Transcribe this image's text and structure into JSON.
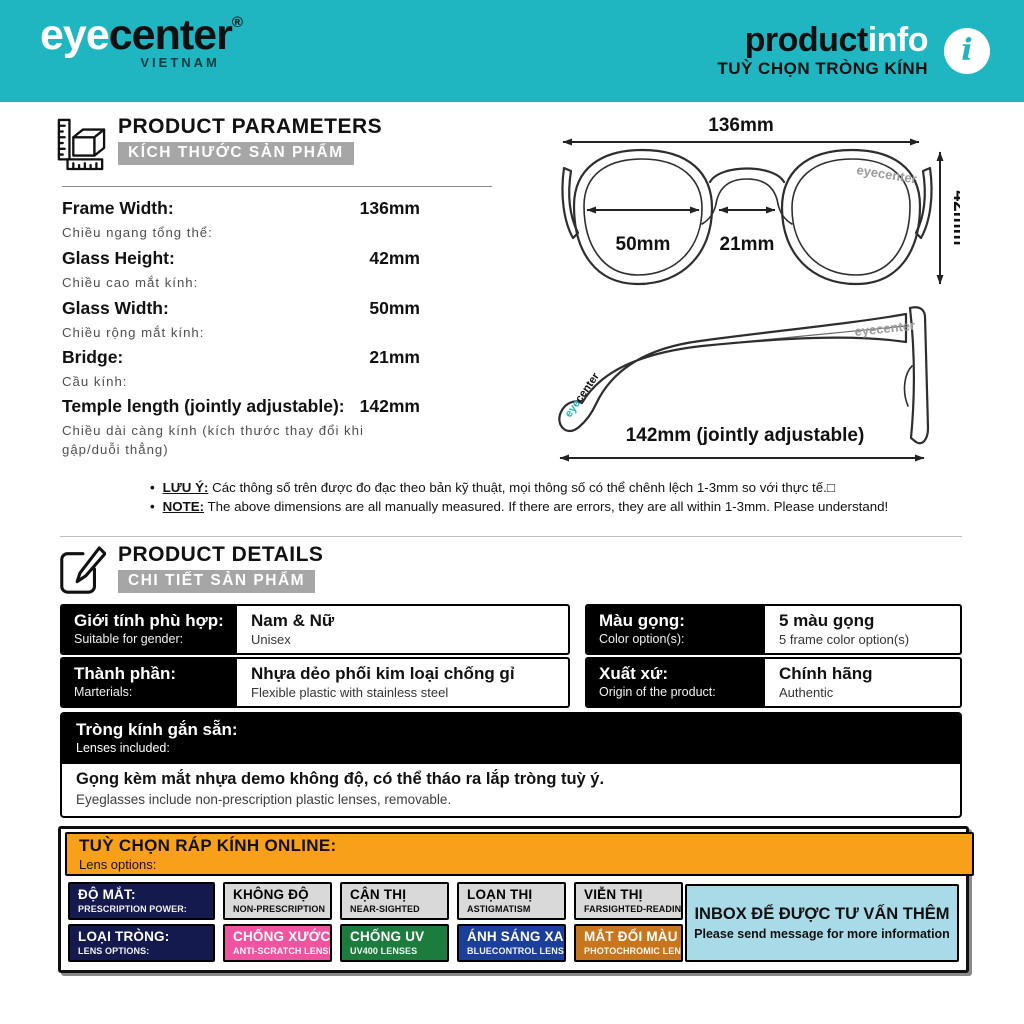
{
  "colors": {
    "teal": "#1FB6C1",
    "gray_badge_bg": "#A6A6A6",
    "orange": "#F9A01B",
    "navy": "#14194E",
    "pink": "#F0539F",
    "green": "#1B7C3D",
    "blue": "#1C3F9C",
    "amber": "#C8761D",
    "light_gray": "#D9D9D9",
    "light_blue": "#A9DAE8"
  },
  "header": {
    "brand_eye": "eye",
    "brand_center": "center",
    "brand_reg": "®",
    "brand_country": "VIETNAM",
    "title_product": "product",
    "title_info": "info",
    "subtitle": "TUỲ CHỌN TRÒNG KÍNH",
    "info_glyph": "i"
  },
  "parameters": {
    "title": "PRODUCT PARAMETERS",
    "subtitle": "KÍCH THƯỚC SẢN PHẨM",
    "rows": [
      {
        "label": "Frame Width:",
        "sub": "Chiều ngang tổng thể:",
        "value": "136mm"
      },
      {
        "label": "Glass Height:",
        "sub": "Chiều cao mắt kính:",
        "value": "42mm"
      },
      {
        "label": "Glass Width:",
        "sub": "Chiều rộng mắt kính:",
        "value": "50mm"
      },
      {
        "label": "Bridge:",
        "sub": "Cầu kính:",
        "value": "21mm"
      },
      {
        "label": "Temple length (jointly adjustable):",
        "sub": "Chiều dài càng kính (kích thước thay đổi khi gập/duỗi thẳng)",
        "value": "142mm"
      }
    ]
  },
  "diagram_front": {
    "width_label": "136mm",
    "height_label": "42mm",
    "lens_label": "50mm",
    "bridge_label": "21mm",
    "watermark": "eyecenter"
  },
  "diagram_side": {
    "length_label": "142mm (jointly adjustable)",
    "watermark": "eyecenter",
    "tip_logo_eye": "eye",
    "tip_logo_center": "center"
  },
  "notes": [
    {
      "bullet": "•",
      "prefix": "LƯU Ý:",
      "text": "Các thông số trên được đo đạc theo bản kỹ thuật, mọi thông số có thể chênh lệch 1-3mm so với thực tế.□"
    },
    {
      "bullet": "•",
      "prefix": "NOTE:",
      "text": "The above dimensions are all manually measured. If there are errors, they are all within 1-3mm. Please understand!"
    }
  ],
  "details": {
    "title": "PRODUCT DETAILS",
    "subtitle": "CHI TIẾT SẢN PHẨM",
    "cells": [
      {
        "label": "Giới tính phù hợp:",
        "label_sub": "Suitable for gender:",
        "value": "Nam & Nữ",
        "value_sub": "Unisex"
      },
      {
        "label": "Màu gọng:",
        "label_sub": "Color option(s):",
        "value": "5 màu gọng",
        "value_sub": "5 frame color option(s)"
      },
      {
        "label": "Thành phần:",
        "label_sub": "Marterials:",
        "value": "Nhựa dẻo phối kim loại chống gỉ",
        "value_sub": "Flexible plastic with stainless steel"
      },
      {
        "label": "Xuất xứ:",
        "label_sub": "Origin of the product:",
        "value": "Chính hãng",
        "value_sub": "Authentic"
      }
    ]
  },
  "lenses_included": {
    "label": "Tròng kính gắn sẵn:",
    "label_sub": "Lenses included:",
    "value": "Gọng kèm mắt nhựa demo không độ, có thể tháo ra lắp tròng tuỳ ý.",
    "value_sub": "Eyeglasses include non-prescription plastic lenses, removable."
  },
  "lens_options": {
    "title": "TUỲ CHỌN RÁP KÍNH ONLINE:",
    "subtitle": "Lens options:",
    "badges": [
      {
        "label": "ĐỘ MẮT:",
        "sub": "PRESCRIPTION POWER:",
        "bg": "#14194E",
        "fg": "#FFFFFF"
      },
      {
        "label": "KHÔNG ĐỘ",
        "sub": "NON-PRESCRIPTION",
        "bg": "#D9D9D9",
        "fg": "#000000"
      },
      {
        "label": "CẬN THỊ",
        "sub": "NEAR-SIGHTED",
        "bg": "#D9D9D9",
        "fg": "#000000"
      },
      {
        "label": "LOẠN THỊ",
        "sub": "ASTIGMATISM",
        "bg": "#D9D9D9",
        "fg": "#000000"
      },
      {
        "label": "VIỄN THỊ",
        "sub": "FARSIGHTED-READING",
        "bg": "#D9D9D9",
        "fg": "#000000"
      },
      {
        "label": "LOẠI TRÒNG:",
        "sub": "LENS OPTIONS:",
        "bg": "#14194E",
        "fg": "#FFFFFF"
      },
      {
        "label": "CHỐNG XƯỚC",
        "sub": "ANTI-SCRATCH LENSES",
        "bg": "#F0539F",
        "fg": "#FFFFFF"
      },
      {
        "label": "CHỐNG UV",
        "sub": "UV400 LENSES",
        "bg": "#1B7C3D",
        "fg": "#FFFFFF"
      },
      {
        "label": "ÁNH SÁNG XANH",
        "sub": "BLUECONTROL LENSES",
        "bg": "#1C3F9C",
        "fg": "#FFFFFF"
      },
      {
        "label": "MẮT ĐỔI MÀU",
        "sub": "PHOTOCHROMIC LENSES",
        "bg": "#C8761D",
        "fg": "#FFFFFF"
      }
    ],
    "inbox": {
      "line1": "INBOX ĐỂ ĐƯỢC TƯ VẤN THÊM",
      "line2": "Please send message for more information"
    }
  }
}
